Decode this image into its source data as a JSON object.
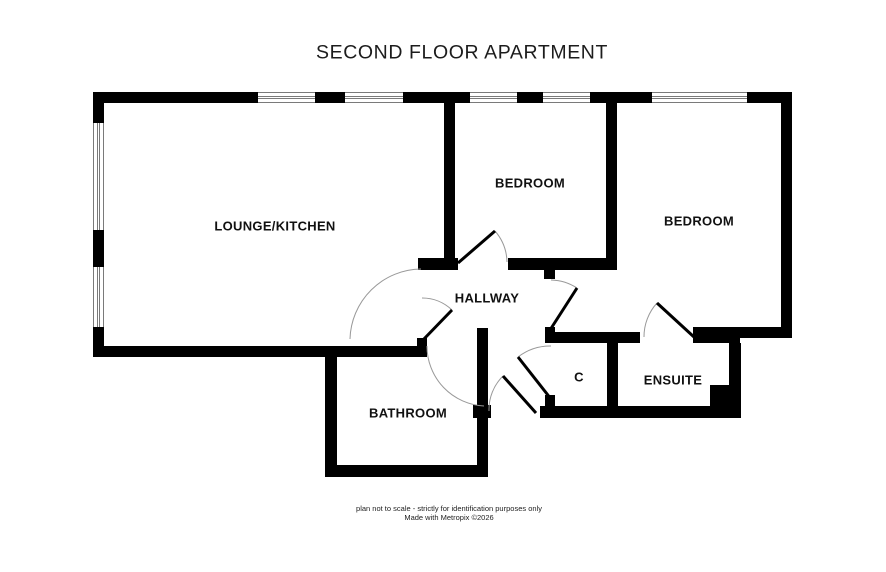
{
  "title": "SECOND FLOOR APARTMENT",
  "rooms": {
    "lounge_kitchen": {
      "label": "LOUNGE/KITCHEN"
    },
    "bedroom1": {
      "label": "BEDROOM"
    },
    "bedroom2": {
      "label": "BEDROOM"
    },
    "hallway": {
      "label": "HALLWAY"
    },
    "bathroom": {
      "label": "BATHROOM"
    },
    "closet": {
      "label": "C"
    },
    "ensuite": {
      "label": "ENSUITE"
    }
  },
  "footer": {
    "line1": "plan not to scale - strictly for identification purposes only",
    "line2": "Made with Metropix ©2026"
  },
  "colors": {
    "wall": "#000000",
    "background": "#ffffff",
    "window_line": "#7a7a7a",
    "door_arc": "#999999",
    "text": "#111111"
  }
}
